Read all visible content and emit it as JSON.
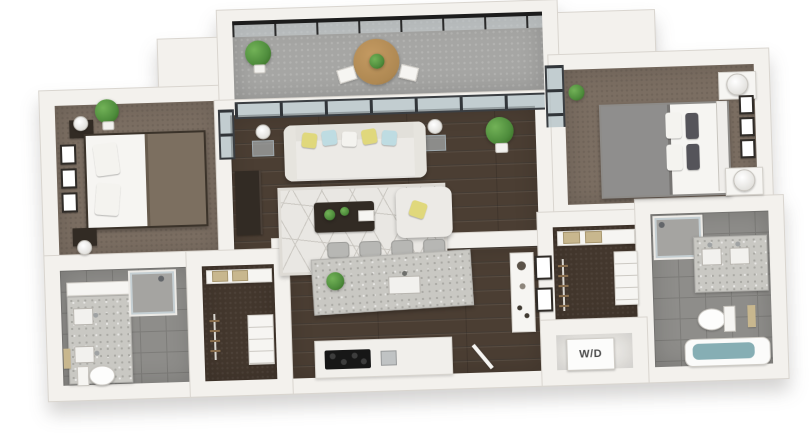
{
  "scene": {
    "type": "3d-floor-plan-render",
    "description": "Isometric 3D rendering of a two-bedroom, two-bathroom apartment floor plan with balcony, open living/kitchen area, two walk-in closets and a laundry closet",
    "background": "#ffffff"
  },
  "labels": {
    "washer_dryer": "W/D"
  },
  "palette": {
    "wall": "#f3f1ed",
    "wall_edge": "#d9d5cf",
    "wood_floor": "#4b3e33",
    "carpet": "#7b6e62",
    "carpet_dark": "#43372d",
    "tile": "#8e8d8a",
    "tile_line": "#7d7c79",
    "concrete": "#a6a6a4",
    "granite": "#c9c8c3",
    "granite_dot": "#a9a8a3",
    "sofa_white": "#eceae6",
    "white_furniture": "#f6f5f2",
    "dark_furniture": "#322b24",
    "rug": "#e9e7e3",
    "rug_line": "#cbc8c2",
    "accent_yellow": "#e0d87c",
    "accent_blue": "#bedce2",
    "plant_green": "#4e8c3c",
    "wood_table": "#ae8852",
    "bedding_gray": "#8f8e8d",
    "bedding_taupe": "#7c6f60",
    "water_teal": "#86aeb4",
    "towel_tan": "#c8b78e",
    "stool_gray": "#b7b7b4",
    "frame_dark": "#2f2b27",
    "railing": "#1c1c1c",
    "label_text": "#4a4a4a"
  },
  "rooms": [
    {
      "id": "bedroom-2",
      "name": "Bedroom 2",
      "floor": "carpet"
    },
    {
      "id": "balcony",
      "name": "Balcony",
      "floor": "concrete"
    },
    {
      "id": "living-room",
      "name": "Living Room",
      "floor": "hardwood"
    },
    {
      "id": "kitchen",
      "name": "Kitchen",
      "floor": "hardwood"
    },
    {
      "id": "bathroom-2",
      "name": "Bathroom 2",
      "floor": "tile"
    },
    {
      "id": "closet-2",
      "name": "Walk-in Closet 2",
      "floor": "carpet"
    },
    {
      "id": "master-bedroom",
      "name": "Master Bedroom",
      "floor": "carpet"
    },
    {
      "id": "master-closet",
      "name": "Master Walk-in Closet",
      "floor": "carpet"
    },
    {
      "id": "master-bathroom",
      "name": "Master Bathroom",
      "floor": "tile"
    },
    {
      "id": "laundry-closet",
      "name": "Laundry Closet",
      "label": "W/D"
    }
  ]
}
